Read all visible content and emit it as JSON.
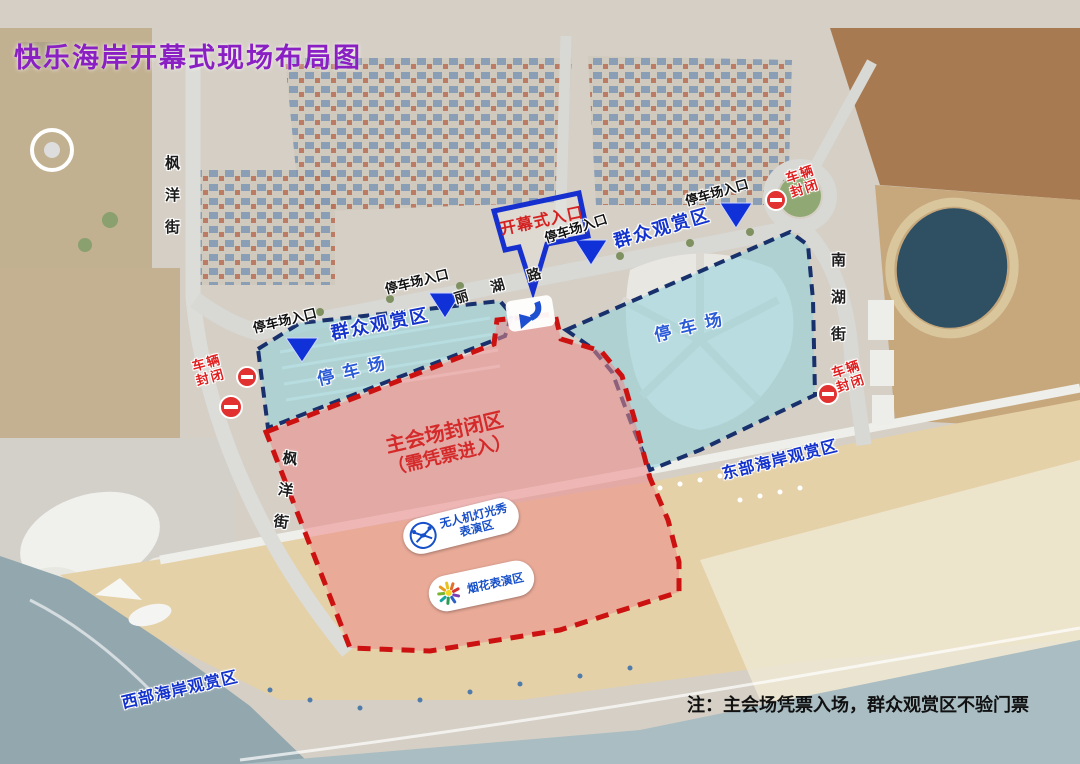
{
  "page": {
    "title": "快乐海岸开幕式现场布局图",
    "note": "注：主会场凭票入场，群众观赏区不验门票"
  },
  "streets": {
    "fengyang": "枫洋街",
    "nanhu": "南湖街",
    "lihu": "丽湖路"
  },
  "zones": {
    "main_venue": {
      "line1": "主会场封闭区",
      "line2": "（需凭票进入）",
      "fill": "#ef8a8a",
      "border": "#cc1111"
    },
    "parking": {
      "label": "停车场",
      "fill": "#8fd3dd",
      "border": "#18306b"
    }
  },
  "labels": {
    "ceremony_entrance": "开幕式入口",
    "parking_entrance": "停车场入口",
    "public_viewing": "群众观赏区",
    "vehicle_closed_l1": "车辆",
    "vehicle_closed_l2": "封闭",
    "drone_l1": "无人机灯光秀",
    "drone_l2": "表演区",
    "fireworks": "烟花表演区",
    "east_coast": "东部海岸观赏区",
    "west_coast": "西部海岸观赏区"
  },
  "icons": {
    "no_entry": "no-entry-icon",
    "entrance_triangle": "entrance-triangle-icon",
    "drone": "drone-icon",
    "fireworks": "fireworks-icon",
    "down_arrow": "down-arrow-icon"
  },
  "colors": {
    "title_purple": "#8a1fc4",
    "viewing_blue": "#1433cc",
    "closed_red": "#e02020",
    "callout_blue": "#1530cf",
    "no_entry_red": "#e23131",
    "triangle_blue": "#1030d8",
    "parking_fill": "#8fd3dd",
    "main_fill": "#ef8a8a",
    "sea": "#93a7af",
    "sand": "#e5d1a8"
  }
}
